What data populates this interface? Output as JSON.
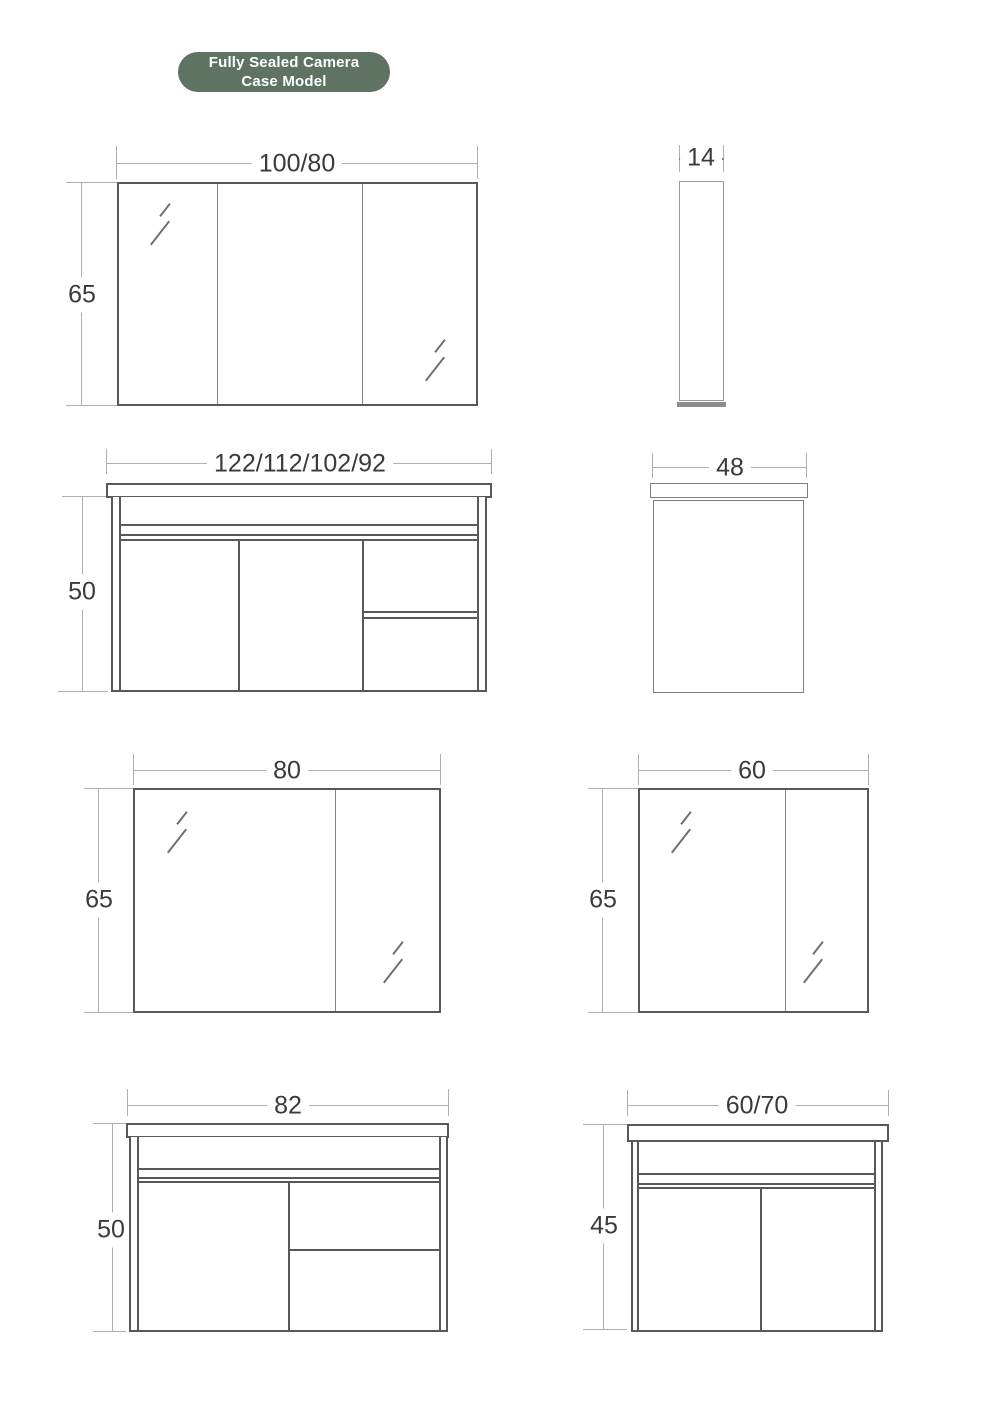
{
  "badge": {
    "line1": "Fully Sealed Camera",
    "line2": "Case Model"
  },
  "colors": {
    "green": "#5e7361",
    "bd": "#57585a",
    "dim": "#a8b1b7",
    "mid": "#7d7f82",
    "lt": "#97999b",
    "txt": "#3a3a3c",
    "glint": "#6b6d70"
  },
  "figures": {
    "mirror_front_100": {
      "name": "triple mirror cabinet front view",
      "width_label": "100/80",
      "height_label": "65"
    },
    "mirror_side_14": {
      "name": "mirror cabinet side view",
      "width_label": "14"
    },
    "vanity_front_122": {
      "name": "vanity cabinet front view",
      "width_label": "122/112/102/92",
      "height_label": "50"
    },
    "vanity_side_48": {
      "name": "vanity cabinet side view",
      "width_label": "48"
    },
    "mirror_front_80": {
      "name": "double mirror cabinet front view",
      "width_label": "80",
      "height_label": "65"
    },
    "mirror_front_60": {
      "name": "double mirror cabinet front view",
      "width_label": "60",
      "height_label": "65"
    },
    "vanity_front_82": {
      "name": "vanity cabinet front view",
      "width_label": "82",
      "height_label": "50"
    },
    "vanity_front_6070": {
      "name": "vanity cabinet front view",
      "width_label": "60/70",
      "height_label": "45"
    }
  }
}
